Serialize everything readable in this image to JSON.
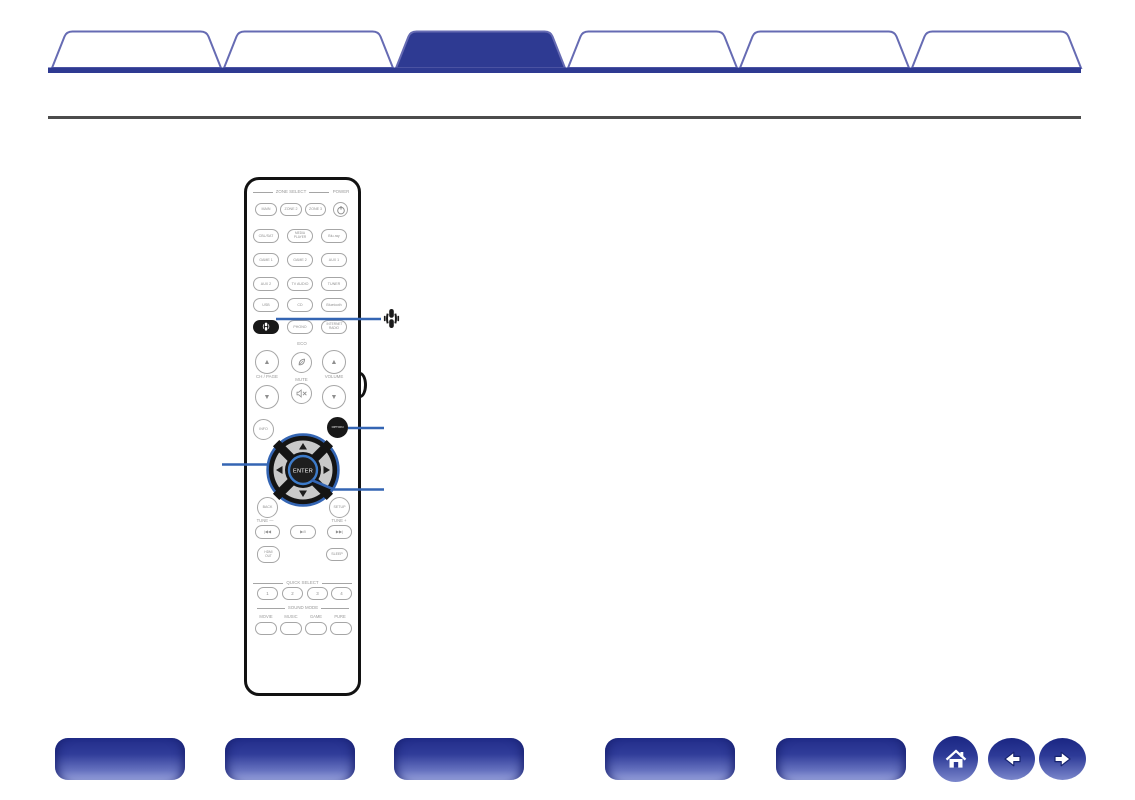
{
  "colors": {
    "tab_fill_active": "#2e3a92",
    "tab_fill_inactive": "#ffffff",
    "tab_border": "#666bb3",
    "baseline_blue": "#2e3a92",
    "divider_gray": "#4c4c4c",
    "callout_blue": "#3465b3",
    "pill_gradient_top": "#222d89",
    "pill_gradient_bottom": "#96a0db"
  },
  "top_tabs": {
    "items": [
      {
        "label": "",
        "active": false,
        "fill": "#ffffff"
      },
      {
        "label": "",
        "active": false,
        "fill": "#ffffff"
      },
      {
        "label": "",
        "active": true,
        "fill": "#2e3a92"
      },
      {
        "label": "",
        "active": false,
        "fill": "#ffffff"
      },
      {
        "label": "",
        "active": false,
        "fill": "#ffffff"
      },
      {
        "label": "",
        "active": false,
        "fill": "#ffffff"
      }
    ]
  },
  "remote": {
    "zone_select_label": "ZONE SELECT",
    "power_label": "POWER",
    "buttons": {
      "main": "MAIN",
      "zone2": "ZONE 2",
      "zone3": "ZONE 3",
      "cbl_sat": "CBL/SAT",
      "media_player": "MEDIA PLAYER",
      "blu_ray": "Blu-ray",
      "game1": "GAME 1",
      "game2": "GAME 2",
      "aux1": "AUX 1",
      "aux2": "AUX 2",
      "tv_audio": "TV AUDIO",
      "tuner": "TUNER",
      "usb": "USB",
      "cd": "CD",
      "bluetooth": "Bluetooth",
      "phono": "PHONO",
      "internet_radio": "INTERNET RADIO",
      "info": "INFO",
      "option": "OPTION",
      "enter": "ENTER",
      "back": "BACK",
      "setup": "SETUP",
      "hdmi_out": "HDMI OUT",
      "sleep": "SLEEP"
    },
    "labels": {
      "eco": "ECO",
      "ch_page": "CH / PAGE",
      "mute": "MUTE",
      "volume": "VOLUME",
      "tune_minus": "TUNE —",
      "tune_plus": "TUNE +",
      "quick_select": "QUICK SELECT",
      "sound_mode": "SOUND MODE",
      "up_arrow": "▲",
      "down_arrow": "▼"
    },
    "transport": {
      "skip_back": "|◀◀",
      "play_pause": "▶/‖",
      "skip_forward": "▶▶|"
    },
    "quick_select": [
      "1",
      "2",
      "3",
      "4"
    ],
    "sound_mode": [
      "MOVIE",
      "MUSIC",
      "GAME",
      "PURE"
    ],
    "icons": {
      "power": "power-icon",
      "heos": "heos-icon",
      "eco_leaf": "leaf-icon",
      "mute": "mute-speaker-icon"
    }
  },
  "bottom_nav": {
    "buttons": [
      {
        "label": ""
      },
      {
        "label": ""
      },
      {
        "label": ""
      },
      {
        "label": ""
      },
      {
        "label": ""
      }
    ],
    "icons": {
      "home": "home-icon",
      "back": "arrow-left-icon",
      "forward": "arrow-right-icon"
    }
  }
}
